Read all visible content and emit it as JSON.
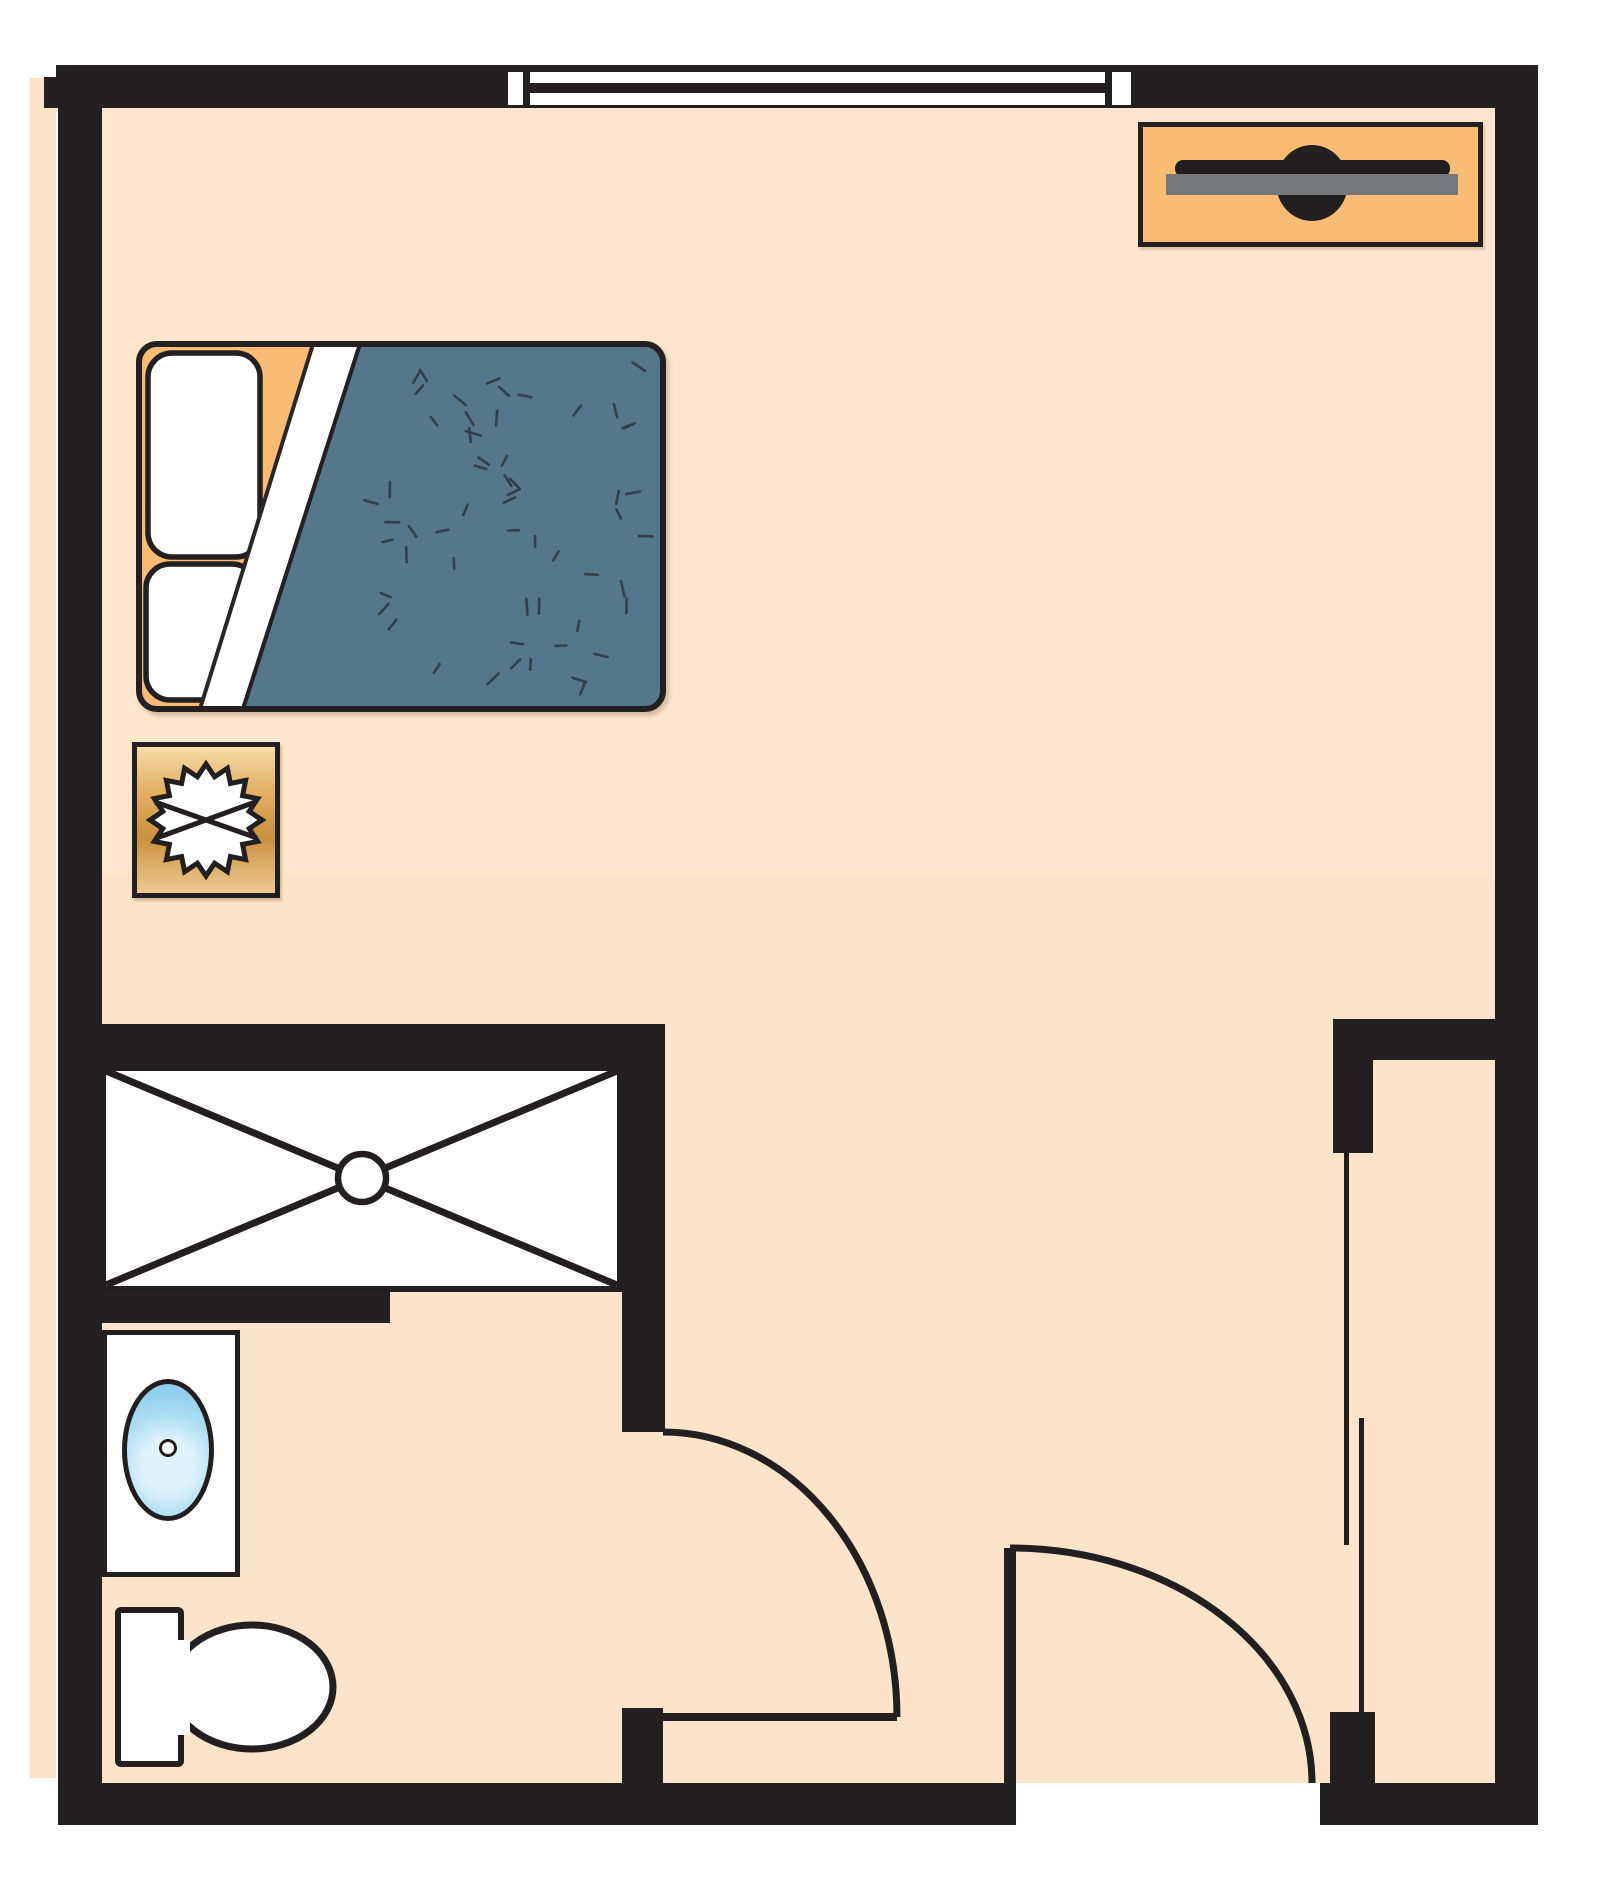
{
  "title": "studio-apartment-floor-plan",
  "colors": {
    "paper": "#FFFFFF",
    "wall": "#241F21",
    "ink": "#231F20",
    "floor": "#FBE4CA",
    "accent_orange": "#F9BC72",
    "blanket_blue": "#54778B",
    "blanket_speckle": "#31414B",
    "tv_gray": "#77787B",
    "nightstand_gold_light": "#F7DCA9",
    "nightstand_gold_dark": "#C8913F",
    "sink_blue_outer": "#7FC4E6",
    "sink_blue_inner": "#DFF2FB",
    "fixture_white": "#FFFFFF"
  },
  "rooms": [
    {
      "name": "main-room"
    },
    {
      "name": "bathroom"
    },
    {
      "name": "closet"
    }
  ],
  "fixtures": [
    {
      "name": "window",
      "wall": "top"
    },
    {
      "name": "tv-console",
      "location": "top-right"
    },
    {
      "name": "bed",
      "pillows": 2,
      "blanket": "speckled"
    },
    {
      "name": "nightstand-with-lamp"
    },
    {
      "name": "shower-with-drain"
    },
    {
      "name": "sink-counter-with-basin"
    },
    {
      "name": "toilet"
    },
    {
      "name": "bathroom-door-swing"
    },
    {
      "name": "entry-door-swing"
    },
    {
      "name": "closet-sliding-doors"
    }
  ],
  "blanket_speckles": {
    "count": 58,
    "seed": 987654,
    "length_min": 10,
    "length_max": 16
  },
  "lamp_star": {
    "points": 16,
    "outer_radius": 56,
    "inner_radius": 44
  }
}
